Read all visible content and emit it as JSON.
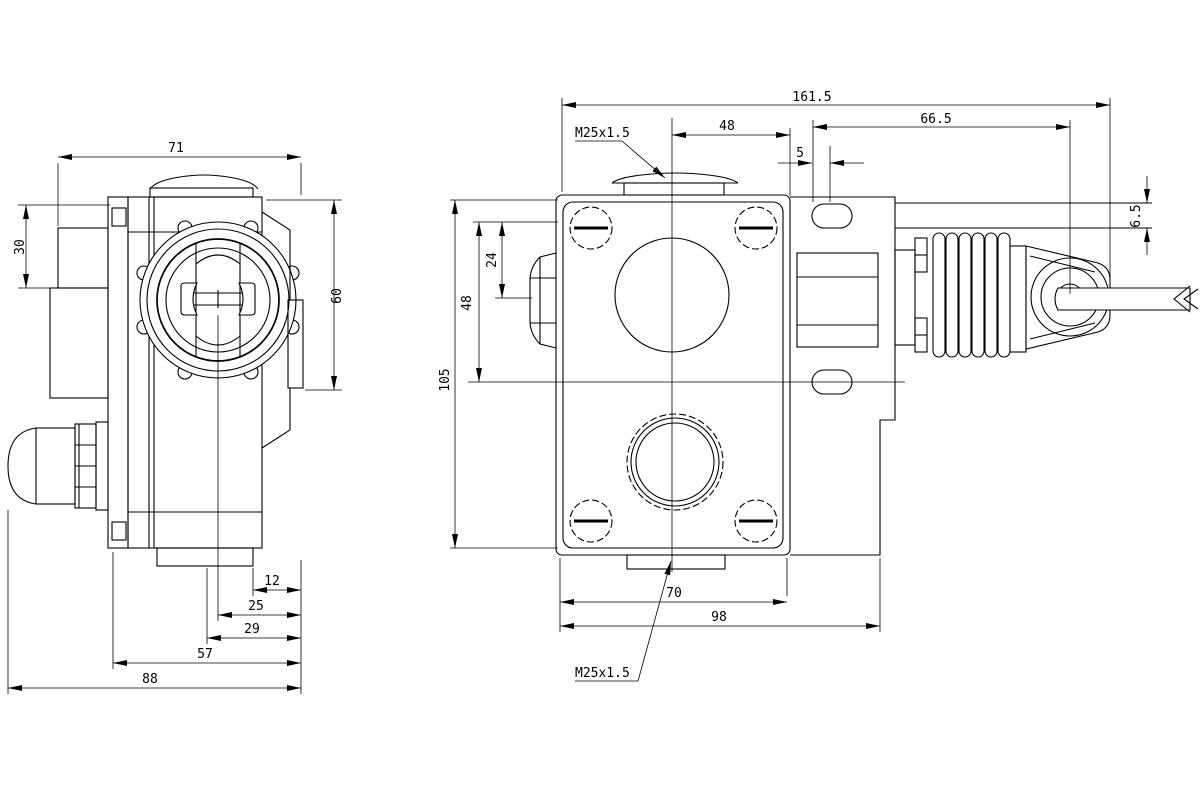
{
  "drawing": {
    "type": "technical-drawing",
    "views": [
      "side-view",
      "front-view"
    ],
    "left_view": {
      "dim_71": "71",
      "dim_30": "30",
      "dim_60": "60",
      "dim_12": "12",
      "dim_25": "25",
      "dim_29": "29",
      "dim_57": "57",
      "dim_88": "88"
    },
    "right_view": {
      "dim_161_5": "161.5",
      "dim_48_top": "48",
      "dim_66_5": "66.5",
      "dim_5": "5",
      "dim_6_5": "6.5",
      "dim_105": "105",
      "dim_48_left": "48",
      "dim_24": "24",
      "dim_70": "70",
      "dim_98": "98",
      "thread_label_top": "M25x1.5",
      "thread_label_bottom": "M25x1.5"
    },
    "colors": {
      "line": "#000000",
      "background": "#ffffff"
    }
  }
}
